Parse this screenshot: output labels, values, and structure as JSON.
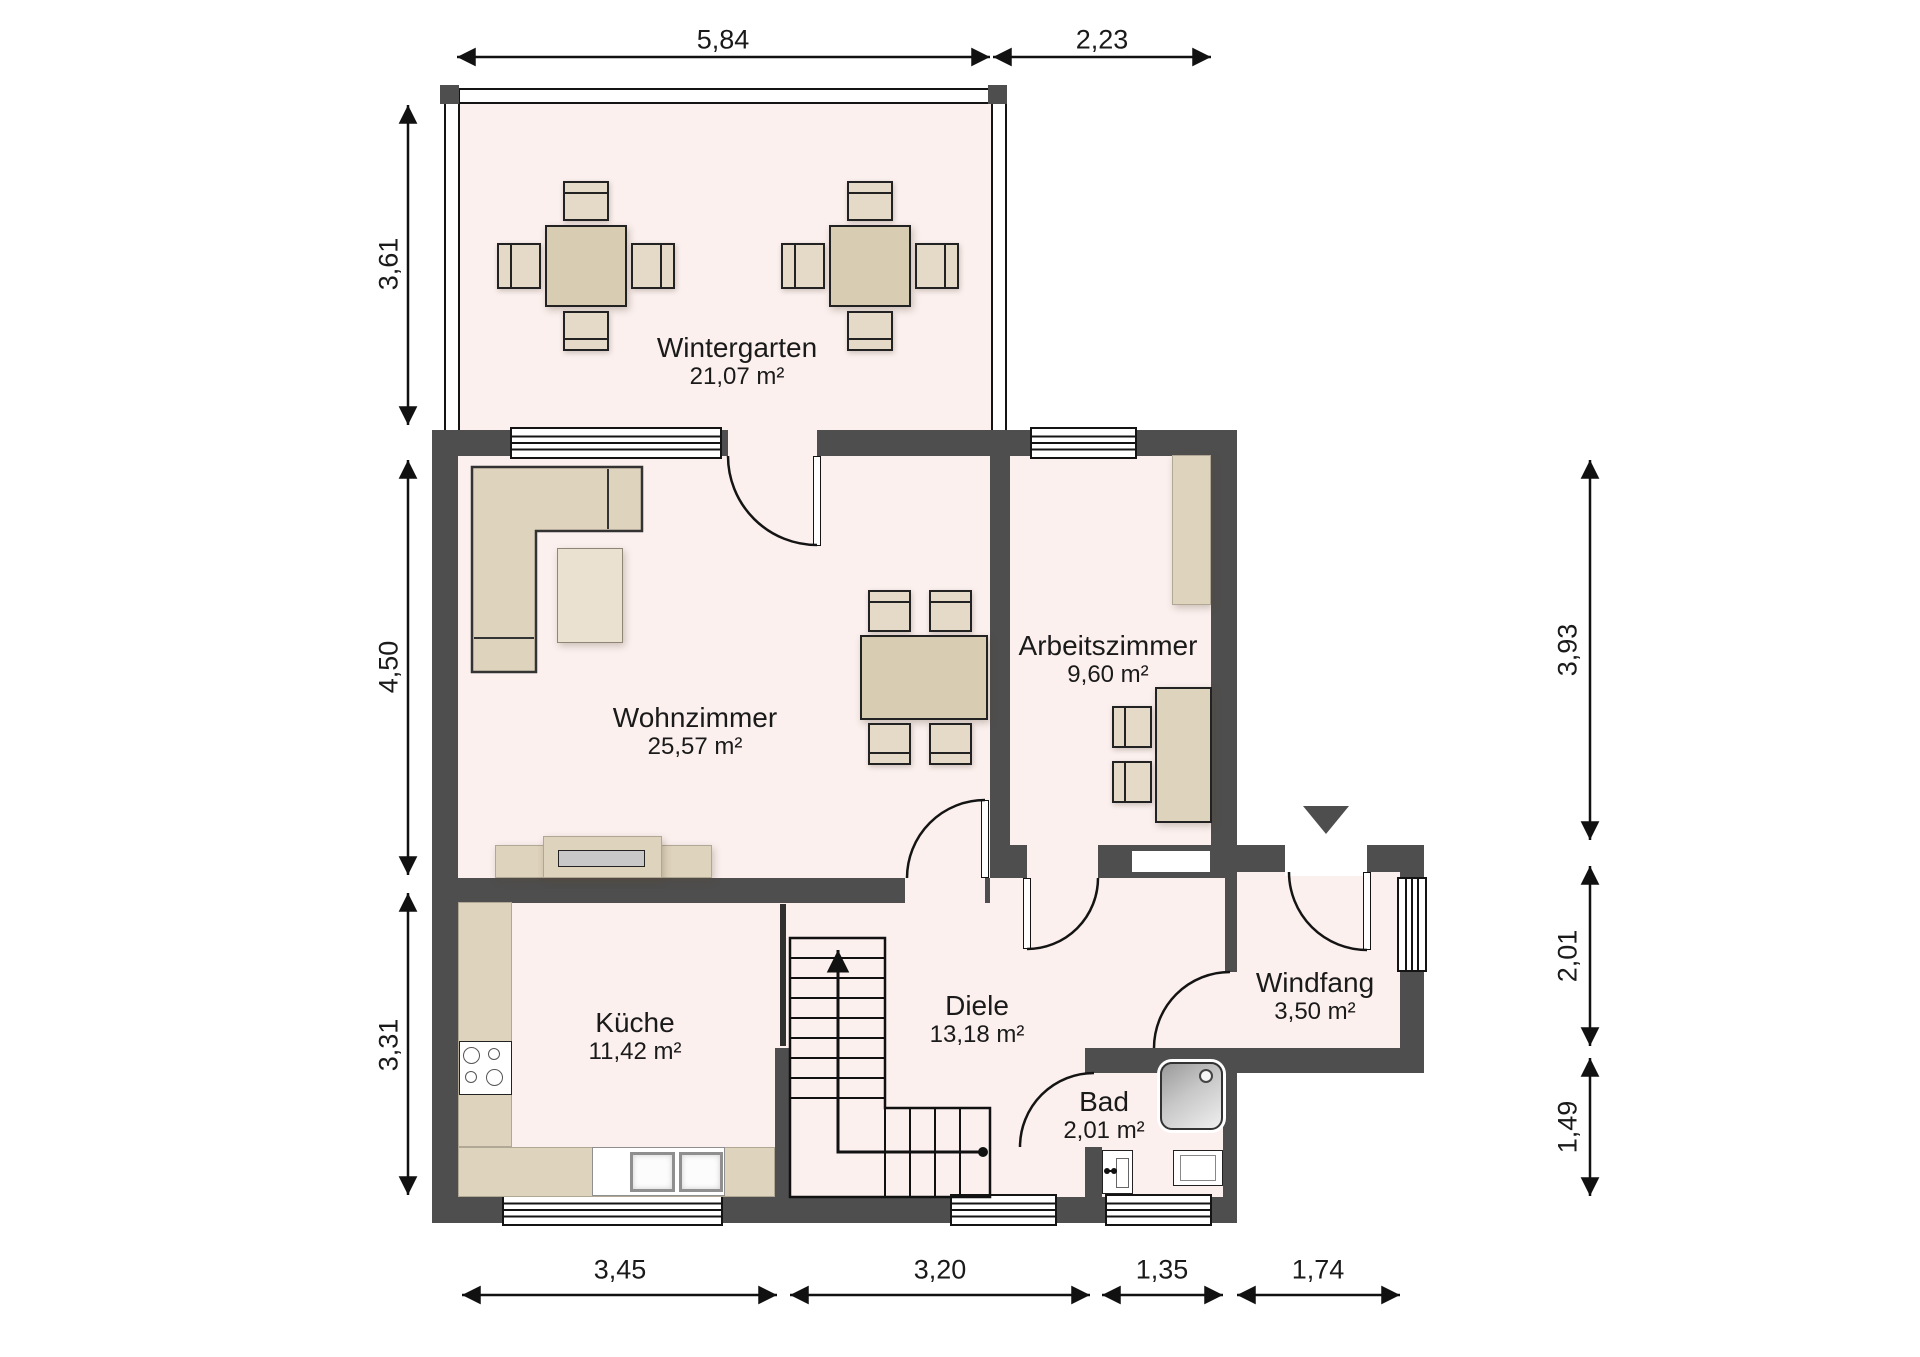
{
  "plan": {
    "rooms": [
      {
        "id": "wintergarten",
        "name": "Wintergarten",
        "area": "21,07 m²"
      },
      {
        "id": "wohnzimmer",
        "name": "Wohnzimmer",
        "area": "25,57 m²"
      },
      {
        "id": "arbeitszimmer",
        "name": "Arbeitszimmer",
        "area": "9,60 m²"
      },
      {
        "id": "kueche",
        "name": "Küche",
        "area": "11,42 m²"
      },
      {
        "id": "diele",
        "name": "Diele",
        "area": "13,18 m²"
      },
      {
        "id": "bad",
        "name": "Bad",
        "area": "2,01 m²"
      },
      {
        "id": "windfang",
        "name": "Windfang",
        "area": "3,50 m²"
      }
    ],
    "dimensions": {
      "top": [
        {
          "value": "5,84"
        },
        {
          "value": "2,23"
        }
      ],
      "left": [
        {
          "value": "3,61"
        },
        {
          "value": "4,50"
        },
        {
          "value": "3,31"
        }
      ],
      "right": [
        {
          "value": "3,93"
        },
        {
          "value": "2,01"
        },
        {
          "value": "1,49"
        }
      ],
      "bottom": [
        {
          "value": "3,45"
        },
        {
          "value": "3,20"
        },
        {
          "value": "1,35"
        },
        {
          "value": "1,74"
        }
      ]
    },
    "colors": {
      "wall": "#4e4e4e",
      "floor": "#fbf0ee",
      "furniture": "#ded3bd",
      "line": "#111111"
    }
  }
}
